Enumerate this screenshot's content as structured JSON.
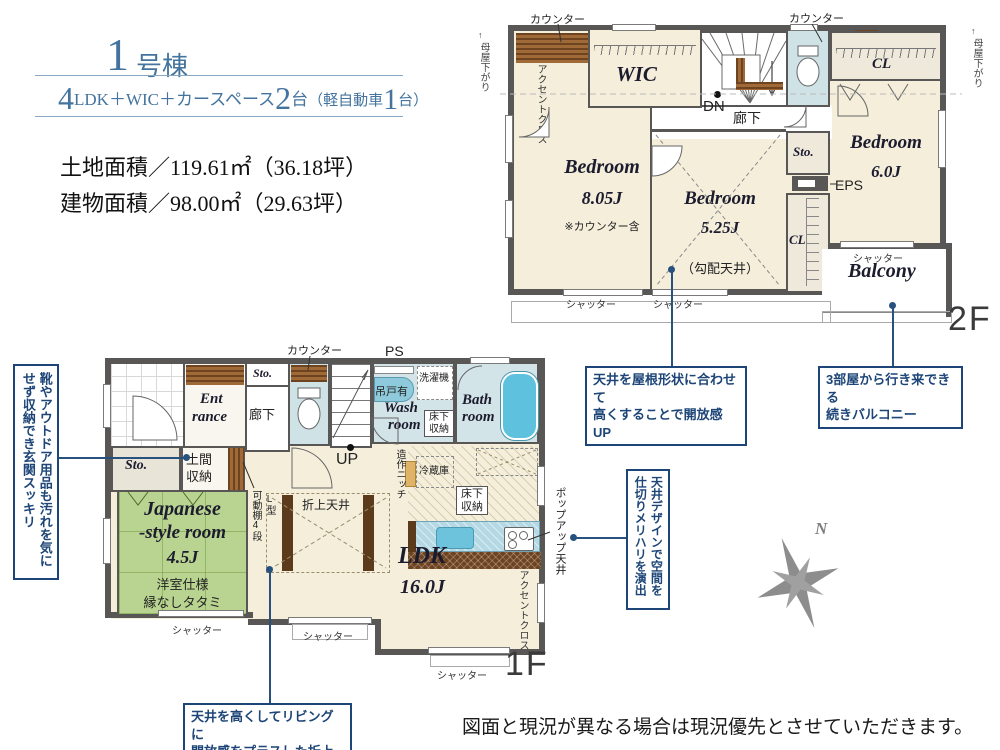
{
  "header": {
    "unit_big": "1",
    "unit_small": "号棟",
    "spec": {
      "b1": "4",
      "t1": "LDK＋WIC＋カースペース",
      "b2": "2",
      "t2": "台",
      "t3": "（軽自動車",
      "b3": "1",
      "t4": "台）"
    },
    "land": "土地面積／119.61㎡（36.18坪）",
    "building": "建物面積／98.00㎡（29.63坪）"
  },
  "common": {
    "shutter": "シャッター",
    "counter": "カウンター",
    "sto": "Sto.",
    "cl": "CL",
    "hall": "廊下",
    "bedroom": "Bedroom",
    "moya": "母屋下がり",
    "moya_arrow": "↑",
    "accent_cloth": "アクセントクロス",
    "yukashita_a": "床下",
    "yukashita_b": "収納"
  },
  "f2": {
    "floor_label": "2F",
    "wic": "WIC",
    "dn": "DN",
    "b1_size": "8.05J",
    "b1_note": "※カウンター含",
    "b2_size": "5.25J",
    "b2_note": "（勾配天井）",
    "b3_size": "6.0J",
    "eps": "EPS",
    "balcony": "Balcony"
  },
  "f1": {
    "floor_label": "1F",
    "up": "UP",
    "ps": "PS",
    "ent1": "Ent",
    "ent2": "rance",
    "doma_a": "土間",
    "doma_b": "収納",
    "kadou_a": "L型",
    "kadou_b": "可動棚4段",
    "tsurido": "吊戸有",
    "washer": "洗濯機",
    "wash1": "Wash",
    "wash2": "room",
    "bath1": "Bath",
    "bath2": "room",
    "fridge": "冷蔵庫",
    "niche": "造作ニッチ",
    "jp1": "Japanese",
    "jp2": "-style room",
    "jp3": "4.5J",
    "jp_note1": "洋室仕様",
    "jp_note2": "縁なしタタミ",
    "ldk": "LDK",
    "ldk_size": "16.0J",
    "oriage": "折上天井",
    "popup": "ポップアップ天井"
  },
  "callouts": {
    "c1a": "天井を屋根形状に合わせて",
    "c1b": "高くすることで開放感UP",
    "c2a": "3部屋から行き来できる",
    "c2b": "続きバルコニー",
    "c3": "天井デザインで空間を仕切りメリハリを演出",
    "c4a": "天井を高くしてリビングに",
    "c4b": "開放感をプラスした折上天井",
    "c5": "靴やアウトドア用品も汚れを気にせず収納でき玄関スッキリ"
  },
  "compass_n": "N",
  "disclaimer": "図面と現況が異なる場合は現況優先とさせていただきます。"
}
